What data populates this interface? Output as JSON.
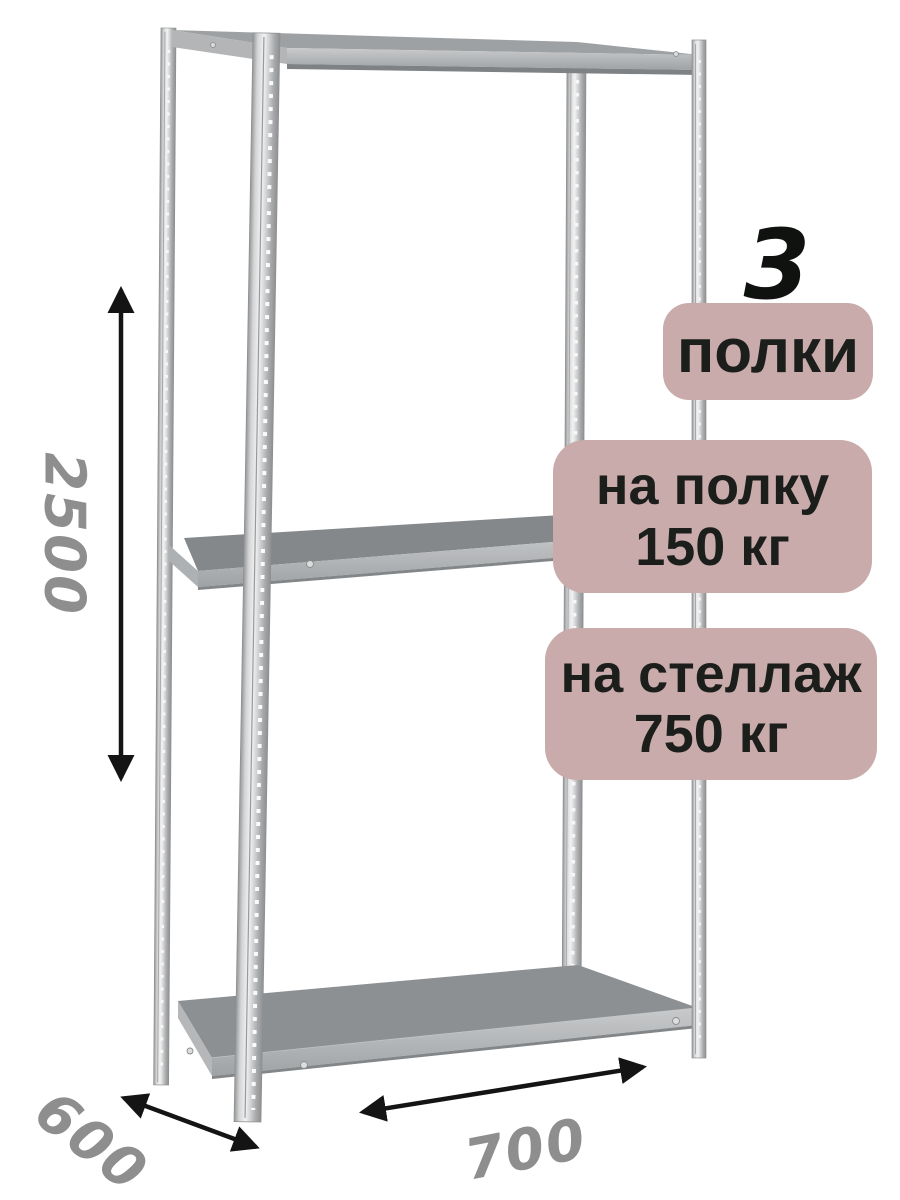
{
  "badges": {
    "shelf_count_number": "3",
    "shelf_count_label": "полки",
    "per_shelf": {
      "line1": "на полку",
      "line2": "150 кг"
    },
    "per_rack": {
      "line1": "на стеллаж",
      "line2": "750 кг"
    }
  },
  "dimensions": {
    "height": "2500",
    "depth": "600",
    "width": "700"
  },
  "icons": {
    "height_arrow": "double-headed-vertical-arrow",
    "depth_arrow": "double-headed-diagonal-arrow",
    "width_arrow": "double-headed-diagonal-arrow"
  },
  "colors": {
    "background": "#ffffff",
    "badge_bg": "#c9abab",
    "badge_text": "#1b1e1b",
    "dimension_text": "#8e8e8e",
    "arrow": "#141414",
    "metal_light": "#f2f2f3",
    "metal_dark": "#8e9092",
    "shelf_surface": "#8d9092"
  }
}
